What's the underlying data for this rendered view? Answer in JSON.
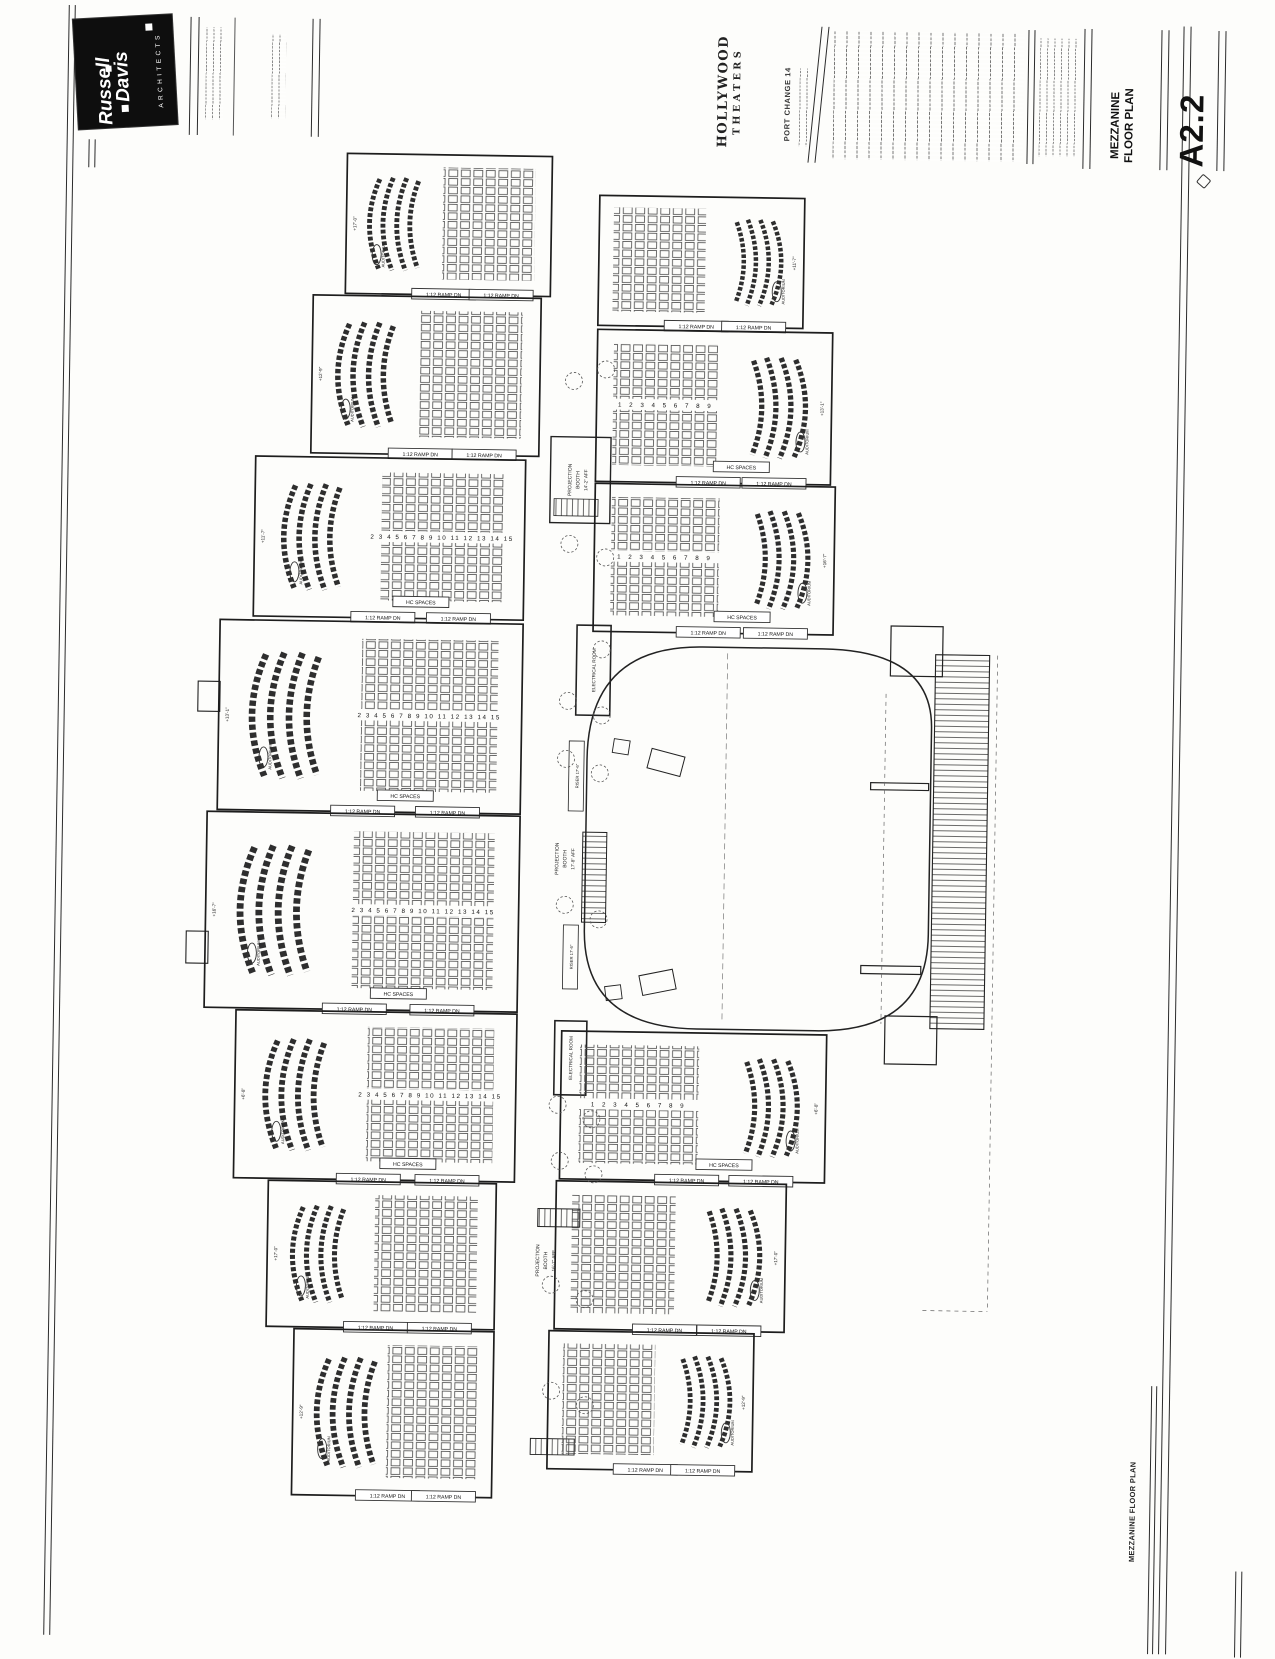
{
  "sheet": {
    "firm": {
      "name_line1": "Russell",
      "name_line2": "Davis",
      "tagline": "ARCHITECTS"
    },
    "project": {
      "name_line1": "HOLLYWOOD",
      "name_line2": "THEATERS"
    },
    "revision_note": "PORT CHANGE 14",
    "title": {
      "line1": "MEZZANINE",
      "line2": "FLOOR PLAN"
    },
    "sheet_number": "A2.2",
    "footer_title": "MEZZANINE FLOOR PLAN"
  },
  "plan": {
    "labels": {
      "ramp": "1:12 RAMP DN",
      "hc": "HC SPACES",
      "auditorium": "AUDITORIUM",
      "projection": "PROJECTION",
      "booth": "BOOTH",
      "booth_aff_top": "14'-2\" AFF",
      "booth_aff_mid": "17'-8\" AFF",
      "booth_aff_bot": "16'-7\" AFF",
      "electrical_room": "ELECTRICAL ROOM",
      "riser": "RISER 17'-6\""
    },
    "row_numbers_wide": "2 3 4 5 6 7 8 9 10 11 12 13 14 15",
    "row_numbers_narrow": "1 2 3 4 5 6 7 8 9",
    "elevations": [
      "+17'-0\"",
      "+12'-9\"",
      "+11'-7\"",
      "+13'-1\"",
      "+16'-7\"",
      "+6'-8\""
    ]
  }
}
